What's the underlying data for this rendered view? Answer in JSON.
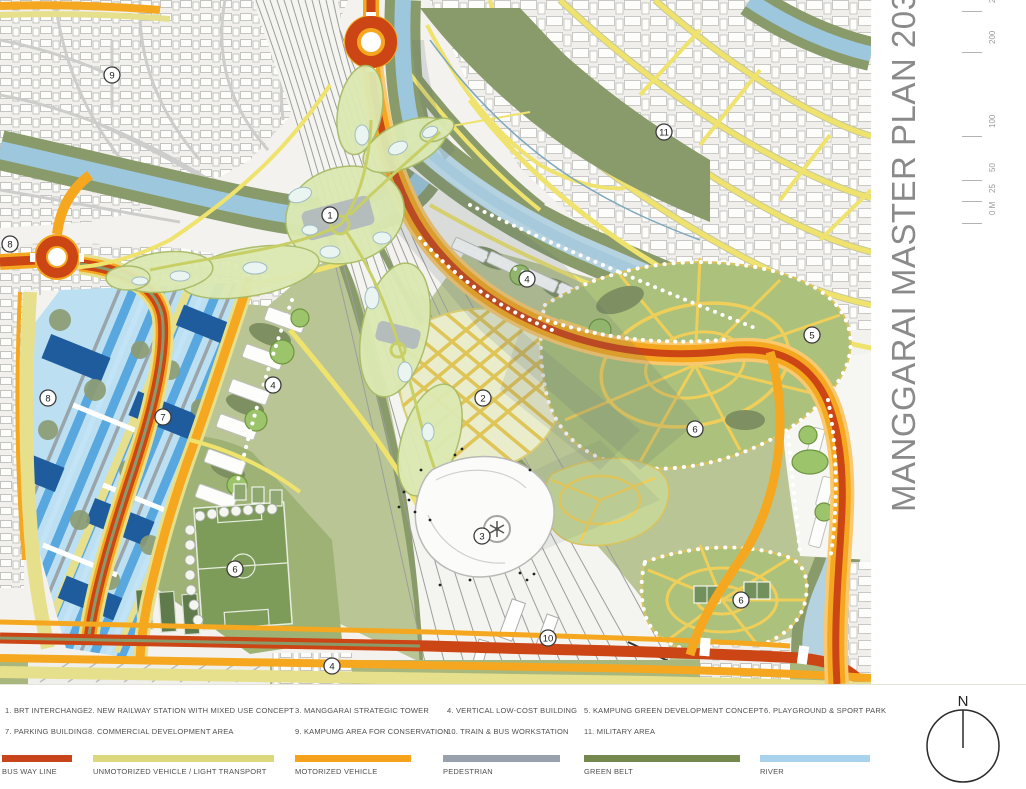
{
  "title": {
    "text": "MANGGARAI MASTER PLAN 2030"
  },
  "compass": {
    "label": "N"
  },
  "scale_bar": {
    "ticks": [
      {
        "label": "0 M",
        "y": 218
      },
      {
        "label": "25",
        "y": 196
      },
      {
        "label": "50",
        "y": 175
      },
      {
        "label": "100",
        "y": 131
      },
      {
        "label": "200",
        "y": 47
      },
      {
        "label": "250",
        "y": 6
      }
    ]
  },
  "legend": {
    "items": [
      {
        "col": 0,
        "row": 0,
        "text": "1. BRT INTERCHANGE"
      },
      {
        "col": 1,
        "row": 0,
        "text": "2. NEW RAILWAY STATION WITH  MIXED USE CONCEPT"
      },
      {
        "col": 2,
        "row": 0,
        "text": "3. MANGGARAI STRATEGIC TOWER"
      },
      {
        "col": 3,
        "row": 0,
        "text": "4. VERTICAL LOW-COST BUILDING"
      },
      {
        "col": 4,
        "row": 0,
        "text": "5. KAMPUNG GREEN DEVELOPMENT CONCEPT"
      },
      {
        "col": 5,
        "row": 0,
        "text": "6. PLAYGROUND & SPORT PARK"
      },
      {
        "col": 0,
        "row": 1,
        "text": "7. PARKING BUILDING"
      },
      {
        "col": 1,
        "row": 1,
        "text": "8. COMMERCIAL DEVELOPMENT AREA"
      },
      {
        "col": 2,
        "row": 1,
        "text": "9. KAMPUMG AREA FOR CONSERVATION"
      },
      {
        "col": 3,
        "row": 1,
        "text": "10. TRAIN & BUS WORKSTATION"
      },
      {
        "col": 4,
        "row": 1,
        "text": "11. MILITARY AREA"
      }
    ],
    "bars": [
      {
        "label": "BUS WAY  LINE",
        "color": "#c8441b",
        "x": 2,
        "w": 70
      },
      {
        "label": "UNMOTORIZED VEHICLE / LIGHT TRANSPORT",
        "color": "#dbd87d",
        "x": 93,
        "w": 181
      },
      {
        "label": "MOTORIZED VEHICLE",
        "color": "#f6a21c",
        "x": 295,
        "w": 116
      },
      {
        "label": "PEDESTRIAN",
        "color": "#99a1af",
        "x": 443,
        "w": 117
      },
      {
        "label": "GREEN BELT",
        "color": "#75894f",
        "x": 584,
        "w": 156
      },
      {
        "label": "RIVER",
        "color": "#a9d3ec",
        "x": 760,
        "w": 110
      }
    ]
  },
  "markers": [
    {
      "n": "1",
      "x": 330,
      "y": 215
    },
    {
      "n": "2",
      "x": 483,
      "y": 398
    },
    {
      "n": "3",
      "x": 482,
      "y": 536
    },
    {
      "n": "4",
      "x": 527,
      "y": 279
    },
    {
      "n": "4",
      "x": 273,
      "y": 385
    },
    {
      "n": "4",
      "x": 332,
      "y": 666
    },
    {
      "n": "5",
      "x": 812,
      "y": 335
    },
    {
      "n": "6",
      "x": 235,
      "y": 569
    },
    {
      "n": "6",
      "x": 695,
      "y": 429
    },
    {
      "n": "6",
      "x": 741,
      "y": 600
    },
    {
      "n": "7",
      "x": 163,
      "y": 417
    },
    {
      "n": "8",
      "x": 10,
      "y": 244
    },
    {
      "n": "8",
      "x": 48,
      "y": 398
    },
    {
      "n": "9",
      "x": 112,
      "y": 75
    },
    {
      "n": "10",
      "x": 548,
      "y": 638
    },
    {
      "n": "11",
      "x": 664,
      "y": 132
    }
  ],
  "map": {
    "colors": {
      "busway": "#cc4514",
      "motorized": "#f5a81f",
      "unmotorized": "#e6e08c",
      "pedestrian": "#9aa2b1",
      "green_belt": "#8a9b6b",
      "river": "#9cc7dc",
      "river_pale": "#b4d2e0",
      "concept_green": "#dce9b2",
      "sage": "#b9c594",
      "stripe_blue": "#58a7df",
      "stripe_pale": "#c3e3f6",
      "stripe_gray": "#9aa5ab",
      "block_dark_blue": "#1e5c9e",
      "web_yellow": "#efcf5a",
      "web_green": "#acc17b"
    }
  }
}
